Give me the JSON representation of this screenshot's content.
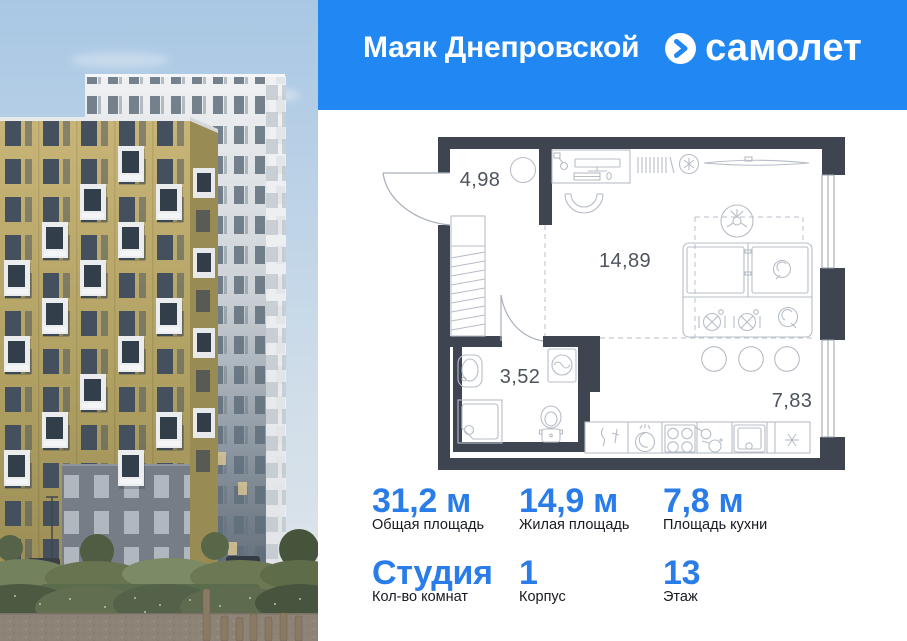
{
  "header": {
    "project_name": "Маяк Днепровской",
    "brand": "самолет"
  },
  "floor_plan": {
    "rooms": [
      {
        "name": "hallway",
        "area": "4,98"
      },
      {
        "name": "living-room",
        "area": "14,89"
      },
      {
        "name": "bathroom",
        "area": "3,52"
      },
      {
        "name": "kitchen",
        "area": "7,83"
      }
    ]
  },
  "stats": {
    "items": [
      {
        "value": "31,2 м",
        "label": "Общая площадь"
      },
      {
        "value": "14,9 м",
        "label": "Жилая площадь"
      },
      {
        "value": "7,8 м",
        "label": "Площадь кухни"
      },
      {
        "value": "Студия",
        "label": "Кол-во комнат"
      },
      {
        "value": "1",
        "label": "Корпус"
      },
      {
        "value": "13",
        "label": "Этаж"
      }
    ]
  },
  "colors": {
    "header_blue": "#2187f2",
    "stat_blue": "#2a7de9",
    "wall": "#3e4551"
  }
}
